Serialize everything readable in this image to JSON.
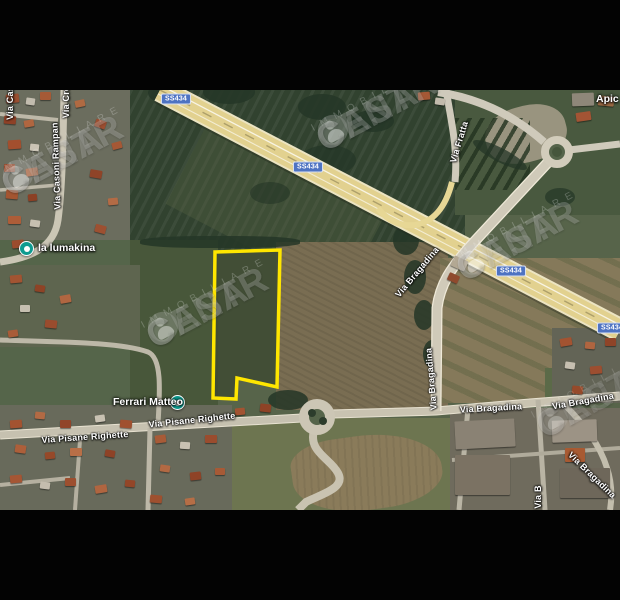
{
  "map": {
    "attribution_watermark": {
      "brand_left": "CENTR",
      "brand_right": "CASA",
      "subtitle": "IMMOBILIARE"
    },
    "shield_label": "SS434",
    "road_labels": {
      "casoni": "Via Casoni Rampan",
      "cas_partial": "Via Cas",
      "cre_partial": "Via Cre",
      "fratta": "Via Fratta",
      "bragadina": "Via Bragadina",
      "bragadina_partial": "Via B",
      "pisane": "Via Pisane Righette",
      "apic_partial": "Apic"
    },
    "place_labels": {
      "lumakina": "la lumakina",
      "ferrari_matteo": "Ferrari Matteo"
    },
    "colors": {
      "parcel_outline": "#ffe600",
      "shield_bg": "#4e73c2",
      "poi_marker": "#0e9b8f",
      "highway": "#e2d18f"
    }
  }
}
